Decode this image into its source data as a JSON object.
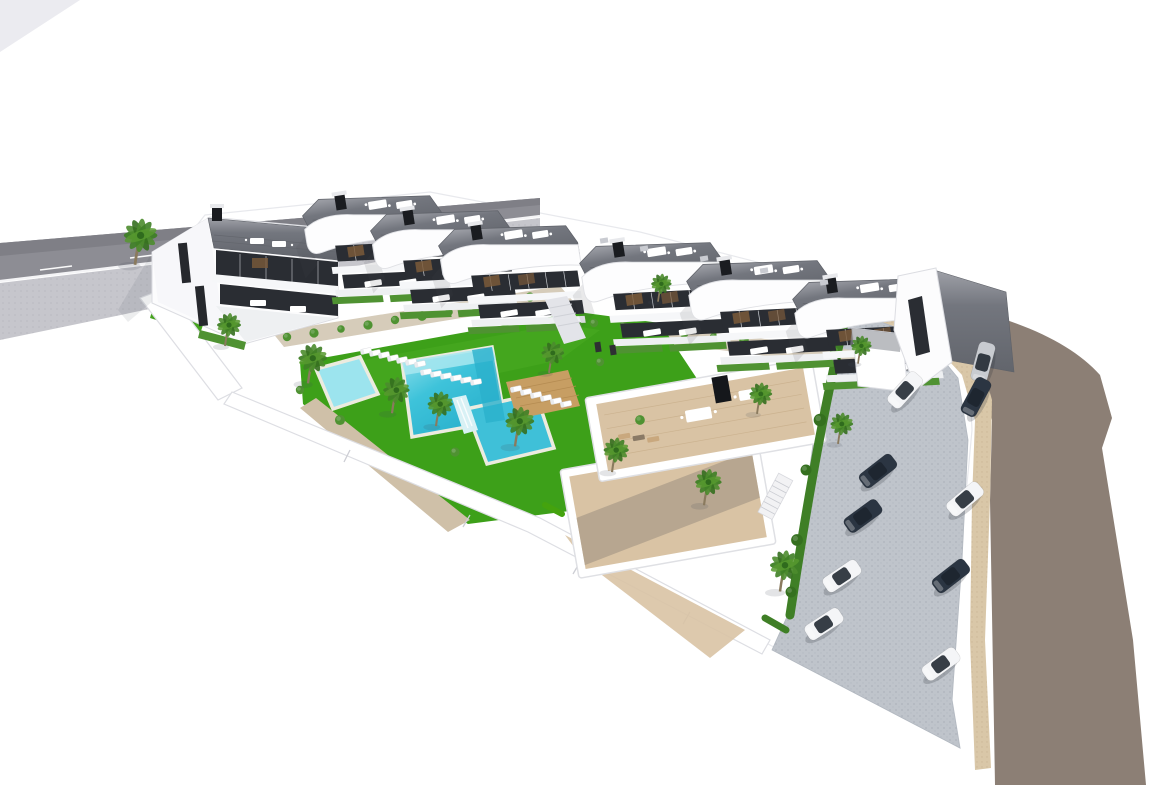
{
  "scene": {
    "title": "Aerial 3D architectural rendering of a coastal residential complex",
    "description": "Bird's-eye render: eight curved white villas with gray rooftop terraces along the top, terraced gardens, central lawn with three connected turquoise pools and sun loungers, wooden deck, palm trees, a lower cluster of white buildings with beige roof decks, paver parking lot with cars, beige sidewalk and a sweeping taupe road on the right, gray road with sidewalk at top-left, all on a white background.",
    "palette": {
      "bg": "#ffffff",
      "asphaltNW": "#8d8d94",
      "asphaltNWdark": "#7f7f86",
      "sidewalkNW": "#c6c6cc",
      "curb": "#f4f4f6",
      "roadEast": "#8c7f75",
      "sidewalkEast": "#d9c7a8",
      "parking": "#bfc4cb",
      "parkingDot": "#aeb4bc",
      "lawn": "#3da019",
      "lawnLight": "#55b32a",
      "terrace": "#d6ccba",
      "gravel": "#cfc0a8",
      "poolMain": "#3ec3da",
      "poolShallow": "#9ce4ee",
      "poolDeep": "#27aecb",
      "poolRim": "#ecebdf",
      "waterfall": "#d8f1f5",
      "deckWood": "#c79e63",
      "deckLine": "#b58c52",
      "villaWhite": "#fcfcfd",
      "villaShade": "#eef0f2",
      "wallStroke": "#dcdde2",
      "roof": "#73767e",
      "roofDark": "#5e6168",
      "glass": "#2a2d33",
      "mullion": "#c9ccd1",
      "pergola": "#7a5a3a",
      "hedge": "#4f9232",
      "hedgeDark": "#35701f",
      "palmGreen": "#3f7f26",
      "palmTrunk": "#8a7a5e",
      "deckBeige": "#d9c3a4",
      "deckBeigeShade": "#a89a88",
      "carDark": "#2b3542",
      "carWhite": "#f4f5f7",
      "carSilver": "#c8cbd0",
      "carGlass": "#1d242e",
      "shadow": "rgba(70,75,85,0.14)"
    },
    "counts": {
      "villas": 8,
      "lower_buildings": 2,
      "pools": 3,
      "cars": 10,
      "palm_trees": 14,
      "sun_loungers": 19,
      "bushes": 31
    }
  },
  "objects": {
    "villas": [
      {
        "x": 300,
        "y": 200,
        "r": -9,
        "s": 1.15
      },
      {
        "x": 368,
        "y": 215,
        "r": -9,
        "s": 1.15
      },
      {
        "x": 436,
        "y": 230,
        "r": -9,
        "s": 1.15
      },
      {
        "x": 577,
        "y": 247,
        "r": -9,
        "s": 1.18
      },
      {
        "x": 684,
        "y": 265,
        "r": -9,
        "s": 1.18
      },
      {
        "x": 790,
        "y": 283,
        "r": -9,
        "s": 1.18
      }
    ],
    "palms": [
      {
        "x": 135,
        "y": 262,
        "s": 1.4
      },
      {
        "x": 225,
        "y": 344,
        "s": 1.0
      },
      {
        "x": 308,
        "y": 381,
        "s": 1.2
      },
      {
        "x": 392,
        "y": 411,
        "s": 1.1
      },
      {
        "x": 436,
        "y": 424,
        "s": 1.05
      },
      {
        "x": 515,
        "y": 444,
        "s": 1.2
      },
      {
        "x": 549,
        "y": 371,
        "s": 0.95
      },
      {
        "x": 612,
        "y": 470,
        "s": 1.05
      },
      {
        "x": 658,
        "y": 300,
        "s": 0.85
      },
      {
        "x": 704,
        "y": 503,
        "s": 1.1
      },
      {
        "x": 780,
        "y": 589,
        "s": 1.25
      },
      {
        "x": 838,
        "y": 442,
        "s": 0.95
      },
      {
        "x": 858,
        "y": 362,
        "s": 0.85
      },
      {
        "x": 757,
        "y": 412,
        "s": 0.95
      }
    ],
    "cars": [
      {
        "x": 983,
        "y": 362,
        "r": -75,
        "c": "carSilver"
      },
      {
        "x": 905,
        "y": 390,
        "r": -48,
        "c": "carWhite"
      },
      {
        "x": 976,
        "y": 397,
        "r": -62,
        "c": "carDark"
      },
      {
        "x": 878,
        "y": 471,
        "r": -38,
        "c": "carDark"
      },
      {
        "x": 863,
        "y": 516,
        "r": -36,
        "c": "carDark"
      },
      {
        "x": 842,
        "y": 576,
        "r": -34,
        "c": "carWhite"
      },
      {
        "x": 824,
        "y": 624,
        "r": -33,
        "c": "carWhite"
      },
      {
        "x": 965,
        "y": 499,
        "r": -40,
        "c": "carWhite"
      },
      {
        "x": 951,
        "y": 576,
        "r": -38,
        "c": "carDark"
      },
      {
        "x": 941,
        "y": 664,
        "r": -36,
        "c": "carWhite"
      }
    ],
    "loungers": [
      {
        "x": 366,
        "y": 351,
        "r": -12
      },
      {
        "x": 375,
        "y": 353,
        "r": -12
      },
      {
        "x": 384,
        "y": 355,
        "r": -12
      },
      {
        "x": 393,
        "y": 358,
        "r": -12
      },
      {
        "x": 402,
        "y": 360,
        "r": -12
      },
      {
        "x": 411,
        "y": 362,
        "r": -12
      },
      {
        "x": 420,
        "y": 364,
        "r": -12
      },
      {
        "x": 516,
        "y": 389,
        "r": -12
      },
      {
        "x": 526,
        "y": 392,
        "r": -12
      },
      {
        "x": 536,
        "y": 395,
        "r": -12
      },
      {
        "x": 546,
        "y": 398,
        "r": -12
      },
      {
        "x": 556,
        "y": 401,
        "r": -12
      },
      {
        "x": 566,
        "y": 404,
        "r": -12
      },
      {
        "x": 426,
        "y": 372,
        "r": -10
      },
      {
        "x": 436,
        "y": 374,
        "r": -10
      },
      {
        "x": 446,
        "y": 376,
        "r": -10
      },
      {
        "x": 456,
        "y": 378,
        "r": -10
      },
      {
        "x": 466,
        "y": 380,
        "r": -10
      },
      {
        "x": 476,
        "y": 382,
        "r": -10
      }
    ],
    "bushes": [
      {
        "x": 287,
        "y": 337,
        "s": 1.0
      },
      {
        "x": 314,
        "y": 333,
        "s": 1.1
      },
      {
        "x": 341,
        "y": 329,
        "s": 0.9
      },
      {
        "x": 368,
        "y": 325,
        "s": 1.1
      },
      {
        "x": 395,
        "y": 320,
        "s": 1.0
      },
      {
        "x": 422,
        "y": 316,
        "s": 1.15
      },
      {
        "x": 449,
        "y": 312,
        "s": 0.9
      },
      {
        "x": 476,
        "y": 307,
        "s": 1.05
      },
      {
        "x": 503,
        "y": 303,
        "s": 1.0
      },
      {
        "x": 530,
        "y": 297,
        "s": 1.1
      },
      {
        "x": 594,
        "y": 323,
        "s": 1.0
      },
      {
        "x": 624,
        "y": 326,
        "s": 1.1
      },
      {
        "x": 654,
        "y": 330,
        "s": 0.95
      },
      {
        "x": 684,
        "y": 333,
        "s": 1.1
      },
      {
        "x": 714,
        "y": 337,
        "s": 1.0
      },
      {
        "x": 744,
        "y": 340,
        "s": 1.15
      },
      {
        "x": 774,
        "y": 344,
        "s": 0.95
      },
      {
        "x": 804,
        "y": 347,
        "s": 1.05
      },
      {
        "x": 834,
        "y": 351,
        "s": 1.0
      },
      {
        "x": 856,
        "y": 354,
        "s": 0.9
      },
      {
        "x": 340,
        "y": 420,
        "s": 1.2
      },
      {
        "x": 455,
        "y": 452,
        "s": 1.1
      },
      {
        "x": 600,
        "y": 362,
        "s": 1.0
      },
      {
        "x": 640,
        "y": 420,
        "s": 1.15
      },
      {
        "x": 560,
        "y": 352,
        "s": 0.9
      },
      {
        "x": 300,
        "y": 390,
        "s": 1.0
      },
      {
        "x": 836,
        "y": 362,
        "s": 1.3,
        "c": "hedgeDark"
      },
      {
        "x": 820,
        "y": 420,
        "s": 1.5,
        "c": "hedgeDark"
      },
      {
        "x": 806,
        "y": 470,
        "s": 1.3,
        "c": "hedgeDark"
      },
      {
        "x": 797,
        "y": 540,
        "s": 1.4,
        "c": "hedgeDark"
      },
      {
        "x": 791,
        "y": 592,
        "s": 1.3,
        "c": "hedgeDark"
      }
    ]
  }
}
